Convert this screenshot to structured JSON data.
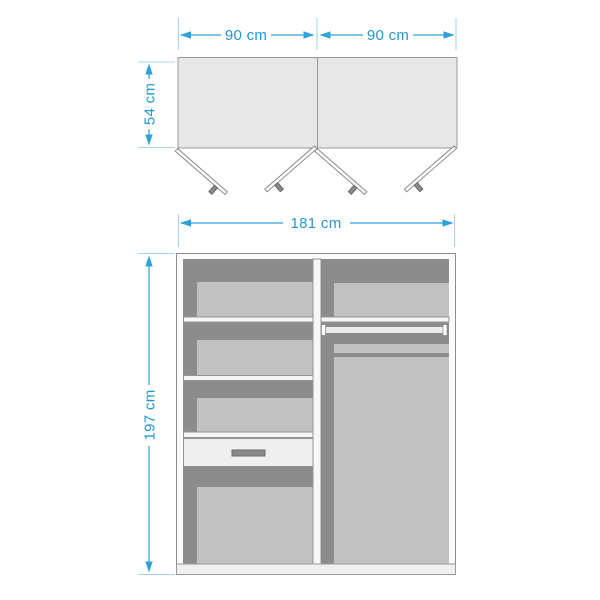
{
  "diagram": {
    "type": "furniture-dimension-diagram",
    "subject": "wardrobe with open doors (top view) and interior front view"
  },
  "labels": {
    "top_view": {
      "left_door_width": "90 cm",
      "right_door_width": "90 cm",
      "depth": "54 cm"
    },
    "front_view": {
      "total_width": "181 cm",
      "total_height": "197 cm"
    }
  },
  "colors": {
    "dimension_accent": "#2fa2d9",
    "dimension_text": "#2496d0",
    "extension_line": "#a7d4ec",
    "cabinet_top_fill": "#e7e7e7",
    "interior_dark": "#8c8c8c",
    "panel_light": "#c1c1c1",
    "shelf_white": "#f7f7f7",
    "drawer_front": "#efefef",
    "handle_gray": "#8a8a8a",
    "outline_gray": "#999999",
    "background": "#ffffff"
  }
}
